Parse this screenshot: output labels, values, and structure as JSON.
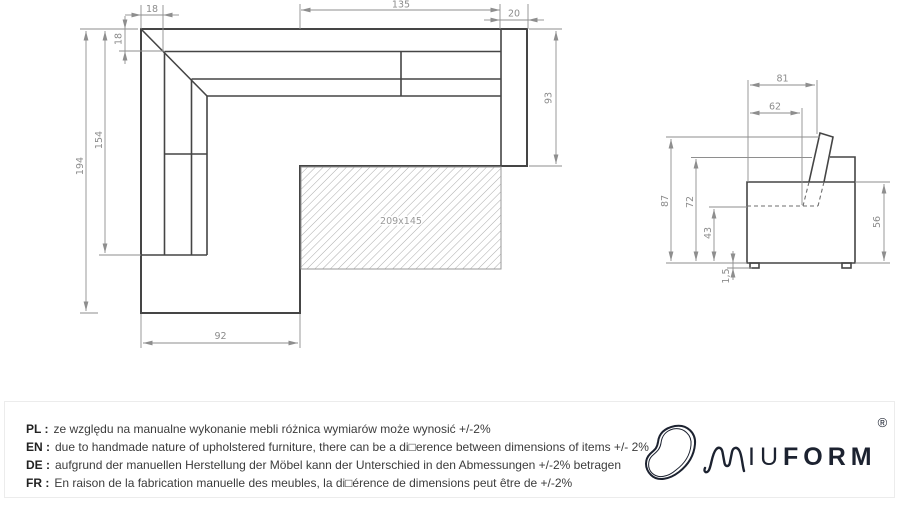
{
  "plan": {
    "dim_armrest_top": "18",
    "dim_backrest_depth": "18",
    "dim_seat_length": "135",
    "dim_armrest_right": "20",
    "dim_depth": "93",
    "dim_chaise_cushion": "154",
    "dim_chaise_length": "194",
    "dim_chaise_width": "92",
    "bed_area": "209x145"
  },
  "side": {
    "dim_depth_total": "81",
    "dim_seat_depth": "62",
    "dim_height_total": "87",
    "dim_backrest_height": "72",
    "dim_seat_height": "43",
    "dim_leg_height": "1,5",
    "dim_body_height": "56"
  },
  "disclaimer": {
    "lines": [
      {
        "code": "PL :",
        "text": "ze względu na manualne wykonanie mebli różnica wymiarów może wynosić +/-2%"
      },
      {
        "code": "EN :",
        "text": "due to handmade nature of upholstered furniture, there can be a di□erence between dimensions of items +/- 2%"
      },
      {
        "code": "DE :",
        "text": "aufgrund der manuellen Herstellung der Möbel kann der Unterschied in den Abmessungen +/-2% betragen"
      },
      {
        "code": "FR :",
        "text": "En raison de la fabrication manuelle des meubles, la di□érence de dimensions peut être de +/-2%"
      }
    ]
  },
  "logo": {
    "text_iu": "IU",
    "text_form": "FORM",
    "registered": "®"
  }
}
